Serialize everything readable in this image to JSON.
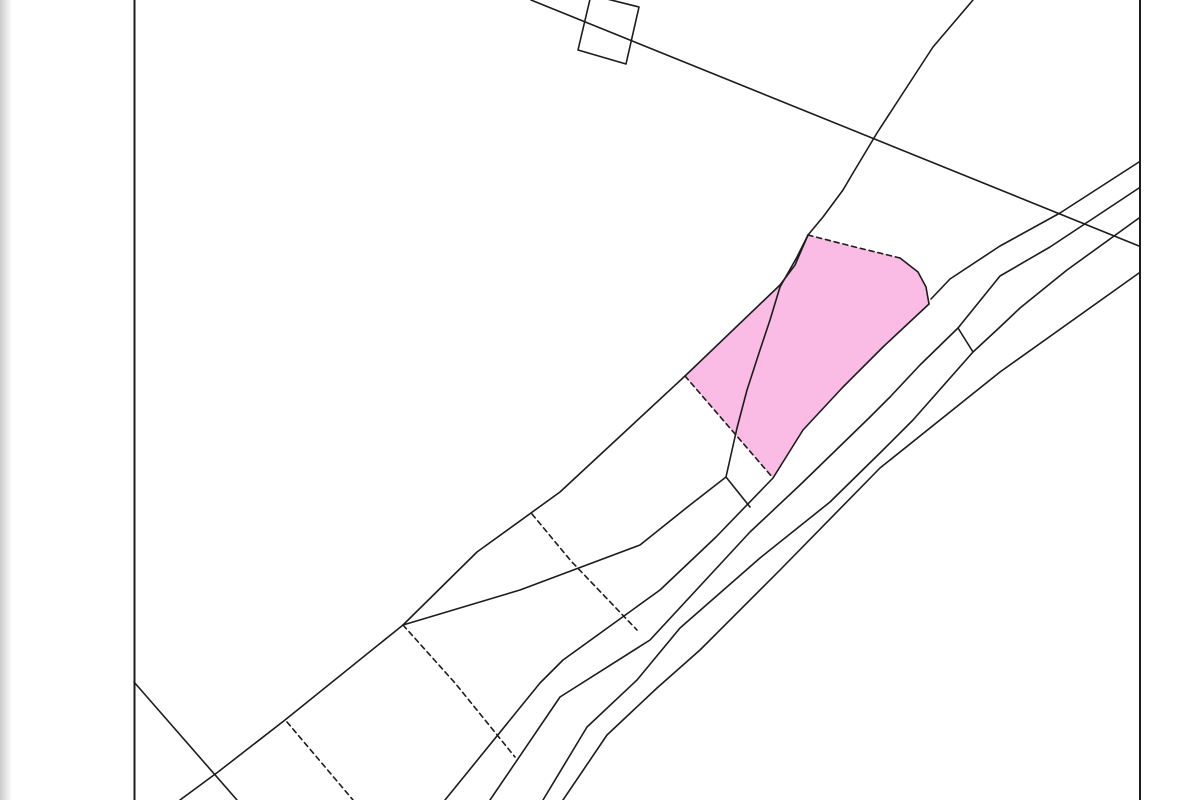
{
  "canvas": {
    "width": 1200,
    "height": 800,
    "background": "#ffffff"
  },
  "map": {
    "frame": {
      "left_x": 134.5,
      "right_x": 1140,
      "stroke": "#1c1c1c",
      "stroke_width": 2
    },
    "left_gutter": {
      "width": 12,
      "color_from": "#cbcbcb",
      "color_to": "#ffffff"
    },
    "line_style": {
      "stroke": "#1c1c1c",
      "stroke_width": 1.6,
      "dash_pattern": "5,4"
    },
    "selected_parcel": {
      "fill": "#FABCE4",
      "points": [
        [
          808,
          235
        ],
        [
          855,
          247
        ],
        [
          900,
          258
        ],
        [
          918,
          272
        ],
        [
          926,
          287
        ],
        [
          929,
          304
        ],
        [
          883,
          347
        ],
        [
          843,
          387
        ],
        [
          803,
          430
        ],
        [
          773,
          478
        ],
        [
          685,
          376
        ],
        [
          780,
          285
        ],
        [
          795,
          265
        ]
      ]
    },
    "lines": [
      {
        "name": "building-outline",
        "dashed": false,
        "points": [
          [
            591,
            -5
          ],
          [
            639,
            7
          ],
          [
            626,
            64
          ],
          [
            578,
            50
          ],
          [
            591,
            -5
          ]
        ]
      },
      {
        "name": "long-diagonal-boundary",
        "dashed": false,
        "points": [
          [
            531,
            0
          ],
          [
            1139,
            246
          ]
        ]
      },
      {
        "name": "curved-path-boundary",
        "dashed": false,
        "points": [
          [
            973,
            0
          ],
          [
            933,
            47
          ],
          [
            903,
            93
          ],
          [
            877,
            133
          ],
          [
            853,
            173
          ],
          [
            843,
            190
          ],
          [
            823,
            217
          ],
          [
            808,
            235
          ],
          [
            797,
            257
          ],
          [
            780,
            287
          ],
          [
            770,
            320
          ],
          [
            760,
            350
          ],
          [
            747,
            390
          ],
          [
            737,
            428
          ],
          [
            726,
            477
          ]
        ]
      },
      {
        "name": "road-edge-upper-1",
        "dashed": false,
        "points": [
          [
            1139,
            162
          ],
          [
            1060,
            213
          ],
          [
            1000,
            246
          ],
          [
            950,
            279
          ],
          [
            931,
            299
          ]
        ]
      },
      {
        "name": "road-edge-upper-2",
        "dashed": false,
        "points": [
          [
            1139,
            188
          ],
          [
            1050,
            247
          ],
          [
            1000,
            276
          ],
          [
            958,
            328
          ],
          [
            920,
            365
          ],
          [
            890,
            397
          ],
          [
            870,
            417
          ],
          [
            800,
            485
          ],
          [
            750,
            532
          ],
          [
            650,
            640
          ],
          [
            560,
            697
          ],
          [
            490,
            800
          ]
        ]
      },
      {
        "name": "road-edge-parcel-side",
        "dashed": false,
        "points": [
          [
            929,
            304
          ],
          [
            883,
            347
          ],
          [
            843,
            387
          ],
          [
            803,
            430
          ],
          [
            773,
            478
          ],
          [
            716,
            537
          ],
          [
            660,
            590
          ],
          [
            563,
            660
          ],
          [
            540,
            683
          ],
          [
            445,
            800
          ]
        ]
      },
      {
        "name": "road-edge-lower-1",
        "dashed": false,
        "points": [
          [
            1139,
            218
          ],
          [
            1067,
            270
          ],
          [
            1020,
            308
          ],
          [
            1000,
            327
          ],
          [
            973,
            352
          ],
          [
            913,
            420
          ],
          [
            883,
            450
          ],
          [
            830,
            502
          ],
          [
            760,
            558
          ],
          [
            680,
            628
          ],
          [
            637,
            680
          ],
          [
            587,
            727
          ],
          [
            543,
            800
          ]
        ]
      },
      {
        "name": "road-edge-lower-2",
        "dashed": false,
        "points": [
          [
            1139,
            273
          ],
          [
            1000,
            372
          ],
          [
            880,
            468
          ],
          [
            780,
            570
          ],
          [
            700,
            650
          ],
          [
            657,
            688
          ],
          [
            607,
            735
          ],
          [
            563,
            800
          ]
        ]
      },
      {
        "name": "road-connector-north",
        "dashed": false,
        "points": [
          [
            958,
            328
          ],
          [
            973,
            352
          ]
        ]
      },
      {
        "name": "road-connector-south",
        "dashed": false,
        "points": [
          [
            726,
            477
          ],
          [
            750,
            507
          ]
        ]
      },
      {
        "name": "strip-upper-boundary",
        "dashed": false,
        "points": [
          [
            685,
            376
          ],
          [
            560,
            492
          ],
          [
            477,
            552
          ],
          [
            403,
            625
          ]
        ]
      },
      {
        "name": "strip-lower-boundary",
        "dashed": false,
        "points": [
          [
            726,
            477
          ],
          [
            690,
            505
          ],
          [
            640,
            545
          ],
          [
            520,
            590
          ],
          [
            403,
            625
          ]
        ]
      },
      {
        "name": "strip-boundary-southwest",
        "dashed": false,
        "points": [
          [
            403,
            625
          ],
          [
            285,
            720
          ],
          [
            218,
            772
          ],
          [
            180,
            800
          ]
        ]
      },
      {
        "name": "corner-diagonal",
        "dashed": false,
        "points": [
          [
            134,
            682
          ],
          [
            237,
            800
          ]
        ]
      },
      {
        "name": "parcel-divider-1",
        "dashed": true,
        "points": [
          [
            403,
            625
          ],
          [
            455,
            683
          ],
          [
            515,
            757
          ]
        ]
      },
      {
        "name": "parcel-divider-2",
        "dashed": true,
        "points": [
          [
            287,
            722
          ],
          [
            353,
            800
          ]
        ]
      },
      {
        "name": "parcel-divider-3",
        "dashed": true,
        "points": [
          [
            532,
            514
          ],
          [
            571,
            561
          ],
          [
            637,
            630
          ]
        ]
      },
      {
        "name": "parcel-edge-top",
        "dashed": true,
        "points": [
          [
            808,
            235
          ],
          [
            855,
            247
          ],
          [
            900,
            258
          ]
        ]
      },
      {
        "name": "parcel-edge-northeast",
        "dashed": false,
        "points": [
          [
            900,
            258
          ],
          [
            918,
            272
          ],
          [
            926,
            287
          ],
          [
            929,
            304
          ]
        ]
      },
      {
        "name": "parcel-edge-southwest",
        "dashed": true,
        "points": [
          [
            685,
            376
          ],
          [
            773,
            478
          ]
        ]
      },
      {
        "name": "parcel-edge-west",
        "dashed": false,
        "points": [
          [
            685,
            376
          ],
          [
            780,
            285
          ],
          [
            795,
            265
          ],
          [
            808,
            235
          ]
        ]
      }
    ]
  }
}
